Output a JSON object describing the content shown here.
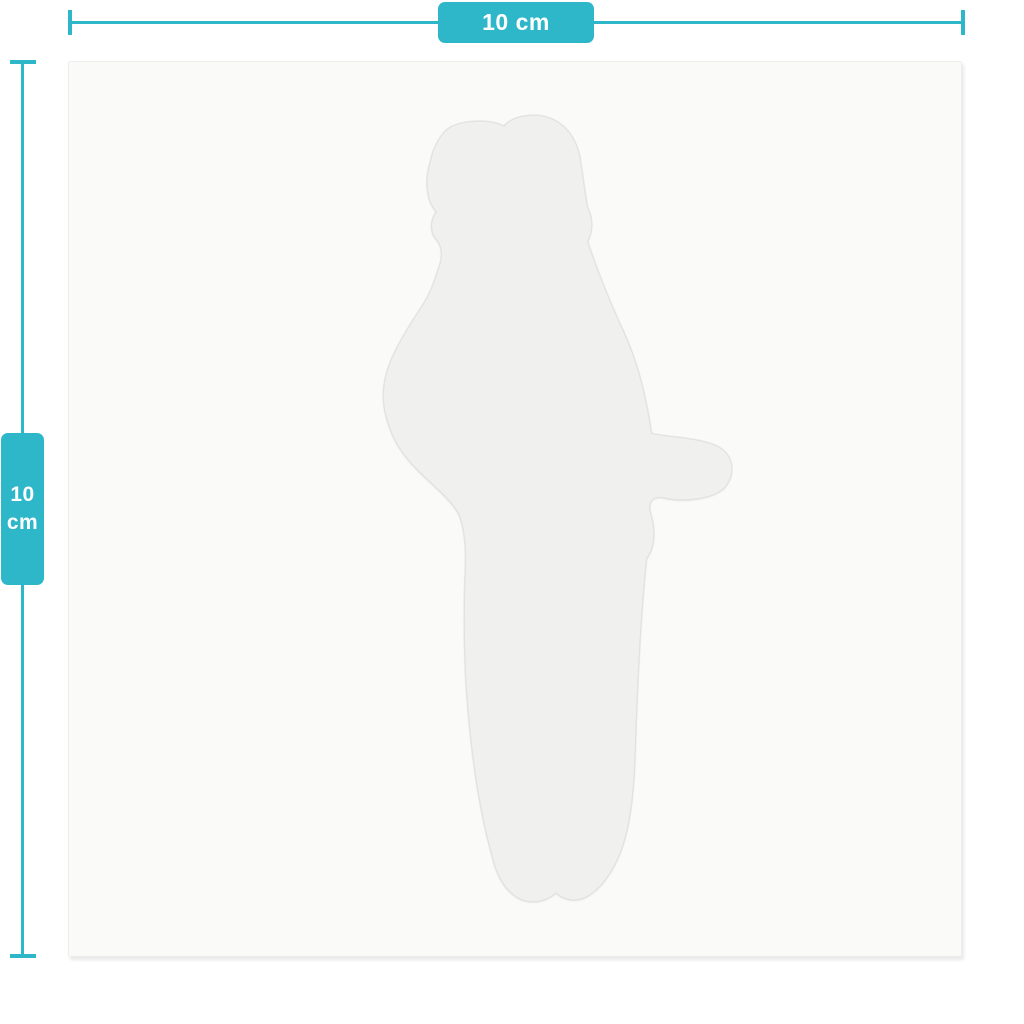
{
  "page": {
    "background_color": "#ffffff"
  },
  "accent_color": "#2eb7c9",
  "rulers": {
    "horizontal": {
      "label": "10 cm"
    },
    "vertical": {
      "value": "10",
      "unit": "cm"
    }
  },
  "canvas": {
    "background_color": "#fafaf9",
    "silhouette_fill": "#f0f0ee",
    "item": "die-cut figure silhouette"
  }
}
